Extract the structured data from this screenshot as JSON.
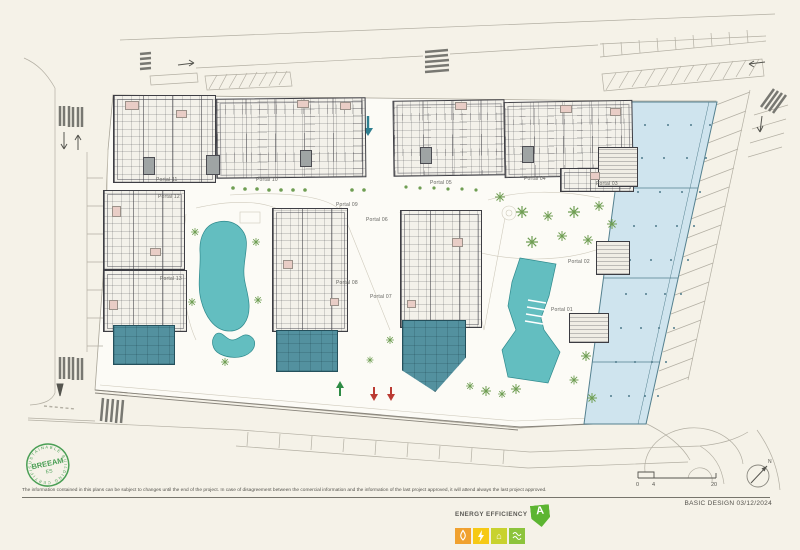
{
  "sheet": {
    "disclaimer": "The information contained in this plans can be subject to changes until the end of the project. In case of disagreement between the comercial information and the information of the last project approved, it will attend always the last project approved.",
    "title_block": "BASIC DESIGN 03/12/2024"
  },
  "breeam_stamp": {
    "name": "BREEAM",
    "region": "ES",
    "arc_text": "SUSTAINABLE BUILDING CERTIFICATE ·",
    "color": "#4a9f55"
  },
  "energy_label": {
    "title": "ENERGY EFFICIENCY",
    "rating": "A",
    "colors": {
      "rating_arrow": "#5cb531",
      "water": "#f0a12f",
      "energy": "#f6c914",
      "house": "#c8d22e",
      "heating": "#8cc43c"
    }
  },
  "scale_bar": {
    "ticks": [
      "0",
      "4",
      "20"
    ]
  },
  "north_arrow": {
    "label": "N"
  },
  "plan": {
    "portals": [
      "Portal 11",
      "Portal 10",
      "Portal 12",
      "Portal 13",
      "Portal 09",
      "Portal 06",
      "Portal 08",
      "Portal 07",
      "Portal 05",
      "Portal 04",
      "Portal 03",
      "Portal 02",
      "Portal 01"
    ],
    "colors": {
      "pool": "#63bec0",
      "commercial_hall": "#cfe4ee",
      "retail_block": "#53919f",
      "terrace": "#e9cdc6",
      "landscape_green": "#6f9e53"
    }
  }
}
